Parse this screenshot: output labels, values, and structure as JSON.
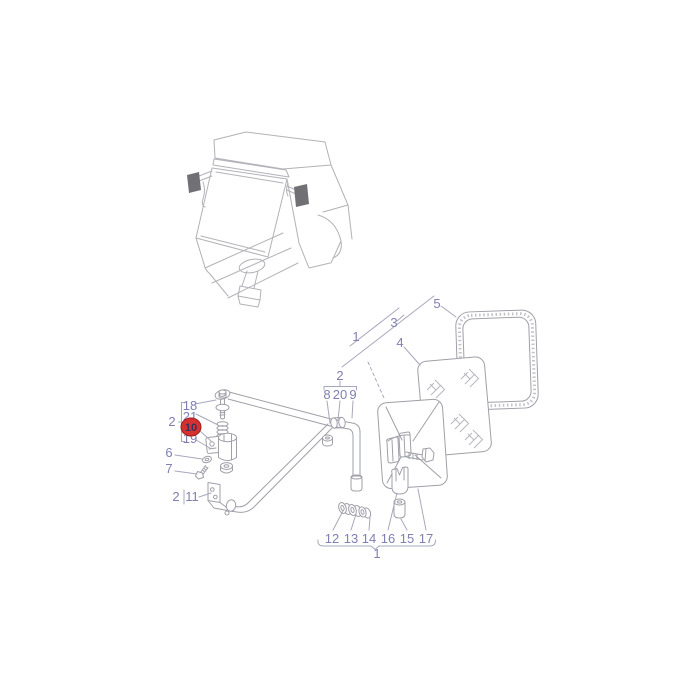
{
  "diagram": {
    "highlighted_part": "10",
    "colors": {
      "background": "#ffffff",
      "label": "#7f7fb2",
      "leader_line": "#a8a8bd",
      "part_line": "#9fa0a8",
      "cab_line": "#b2b2b8",
      "cab_mirror_fill": "#707075",
      "highlight_fill": "#d63131",
      "highlight_border": "#9c1c1c",
      "highlight_text": "#33335f"
    }
  },
  "labels": {
    "top_1": "1",
    "top_2": "2",
    "top_3": "3",
    "top_4": "4",
    "top_5": "5",
    "mid_8": "8",
    "mid_20": "20",
    "mid_9": "9",
    "left_18": "18",
    "left_21": "21",
    "left_group_2": "2",
    "left_10": "10",
    "left_19": "19",
    "left_6": "6",
    "left_7": "7",
    "bracket_2": "2",
    "bracket_11": "11",
    "bottom_12": "12",
    "bottom_13": "13",
    "bottom_14": "14",
    "bottom_16": "16",
    "bottom_15": "15",
    "bottom_17": "17",
    "bottom_1": "1"
  }
}
